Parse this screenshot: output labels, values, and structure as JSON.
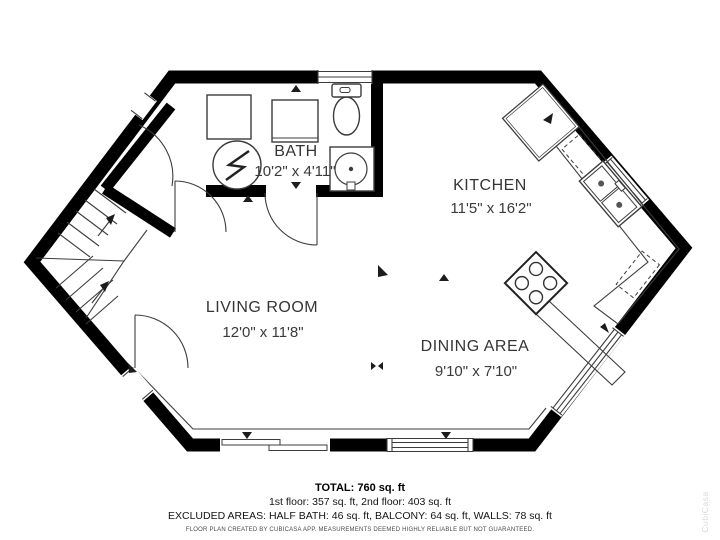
{
  "rooms": [
    {
      "name": "BATH",
      "dims": "10'2\" x 4'11\""
    },
    {
      "name": "KITCHEN",
      "dims": "11'5\" x 16'2\""
    },
    {
      "name": "LIVING ROOM",
      "dims": "12'0\" x 11'8\""
    },
    {
      "name": "DINING AREA",
      "dims": "9'10\" x 7'10\""
    }
  ],
  "summary": {
    "total": "TOTAL: 760 sq. ft",
    "floors": "1st floor: 357 sq. ft, 2nd floor: 403 sq. ft",
    "excluded": "EXCLUDED AREAS: HALF BATH: 46 sq. ft, BALCONY: 64 sq. ft, WALLS: 78 sq. ft"
  },
  "disclaimer": "FLOOR PLAN CREATED BY CUBICASA APP. MEASUREMENTS DEEMED HIGHLY RELIABLE BUT NOT GUARANTEED.",
  "watermark": "CubiCasa",
  "colors": {
    "wall": "#000000",
    "line": "#3c3c3c",
    "text": "#353535",
    "watermark": "#d9d9d9"
  }
}
